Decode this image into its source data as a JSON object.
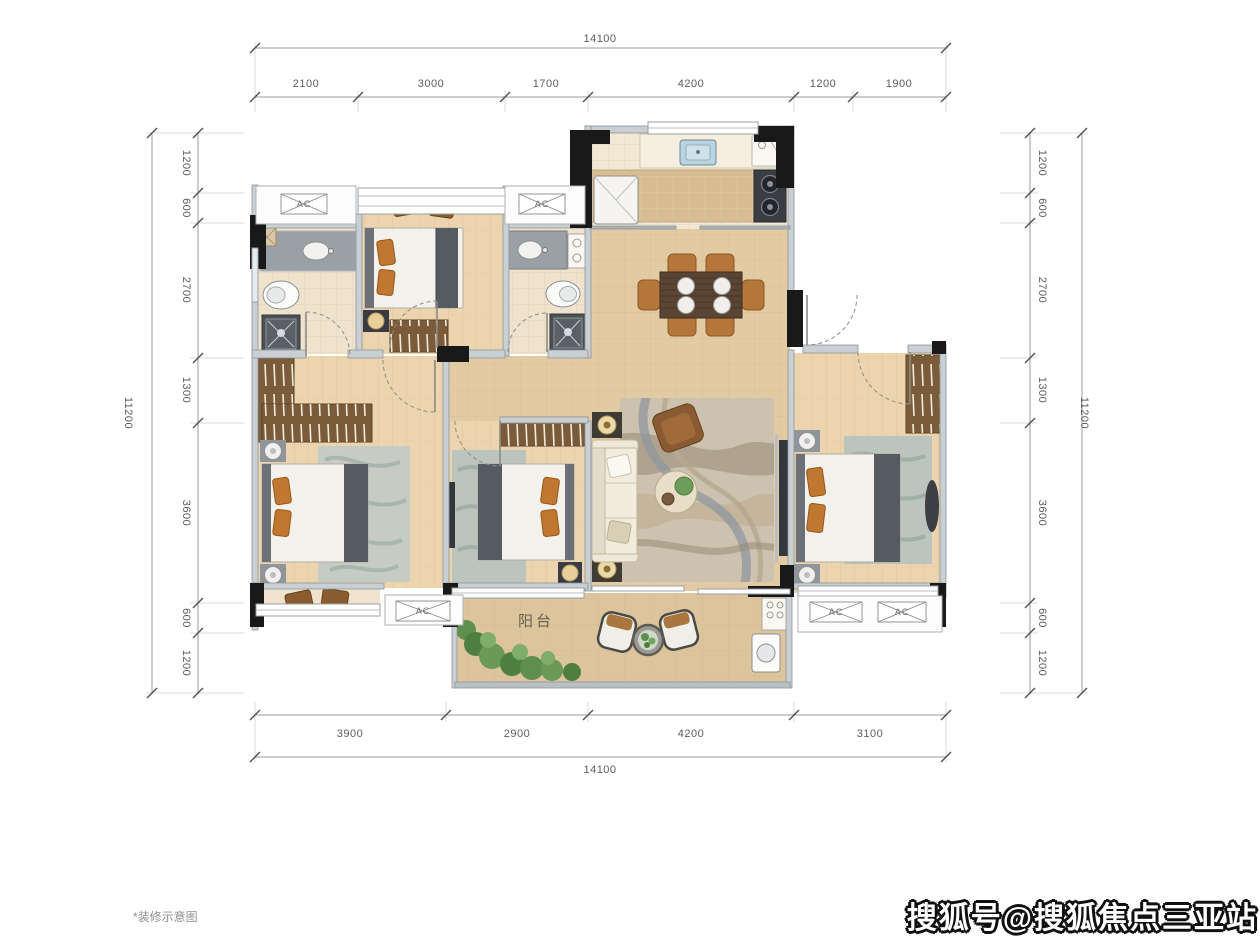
{
  "plan": {
    "balcony_label": "阳台",
    "ac_label": "AC"
  },
  "dimensions": {
    "top": {
      "total": "14100",
      "segments": [
        "2100",
        "3000",
        "1700",
        "4200",
        "1200",
        "1900"
      ]
    },
    "bottom": {
      "total": "14100",
      "segments": [
        "3900",
        "2900",
        "4200",
        "3100"
      ]
    },
    "left": {
      "total": "11200",
      "segments": [
        "1200",
        "600",
        "2700",
        "1300",
        "3600",
        "600",
        "1200"
      ]
    },
    "right": {
      "total": "11200",
      "segments": [
        "1200",
        "600",
        "2700",
        "1300",
        "3600",
        "600",
        "1200"
      ]
    }
  },
  "footer": {
    "note": "*装修示意图"
  },
  "watermark": {
    "text": "搜狐号@搜狐焦点三亚站"
  },
  "colors": {
    "marble_floor": "#e2cba3",
    "wood_floor": "#ecd5ae",
    "bath_floor": "#efe3cd",
    "wall": "#c9cfd2",
    "column": "#191919",
    "furniture_orange": "#c0772f",
    "rug_teal": "#b7c3bf",
    "dim_text": "#5c5c5c"
  }
}
